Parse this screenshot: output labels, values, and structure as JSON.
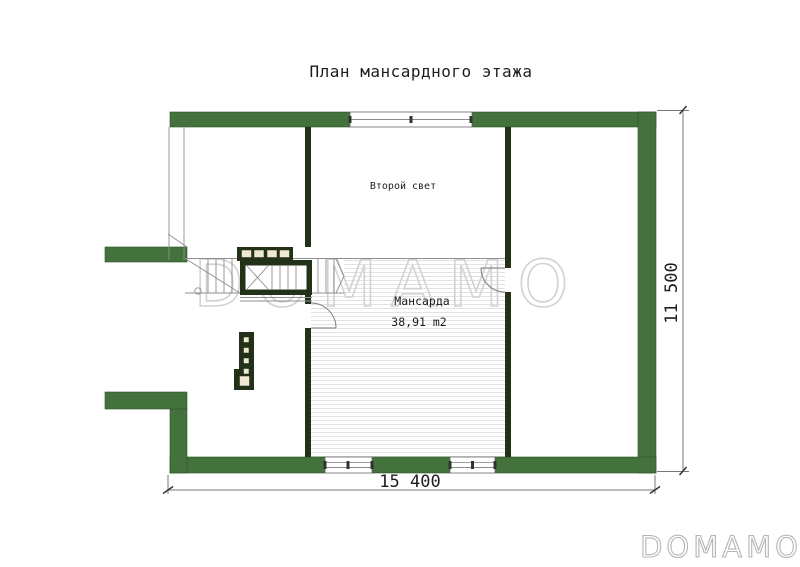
{
  "page_title": "План мансардного этажа",
  "plan": {
    "rooms": [
      {
        "label": "Второй свет"
      },
      {
        "label": "Мансарда",
        "area": "38,91 m2"
      }
    ],
    "dimensions": {
      "width_mm": "15 400",
      "height_mm": "11 500"
    }
  },
  "watermark": {
    "text": "DOMAMO"
  },
  "logo": {
    "text": "DOMAMO"
  },
  "colors": {
    "wall_green": "#43723c",
    "wall_edge": "#2f5128",
    "dark_green": "#243119",
    "cream": "#efe9d2",
    "line_gray": "#8f8f8f",
    "hatch_gray": "#e2e2e2",
    "watermark_gray": "#d2d2d2",
    "logo_gray": "#b5b5b5",
    "text_dark": "#1d1d1d"
  }
}
